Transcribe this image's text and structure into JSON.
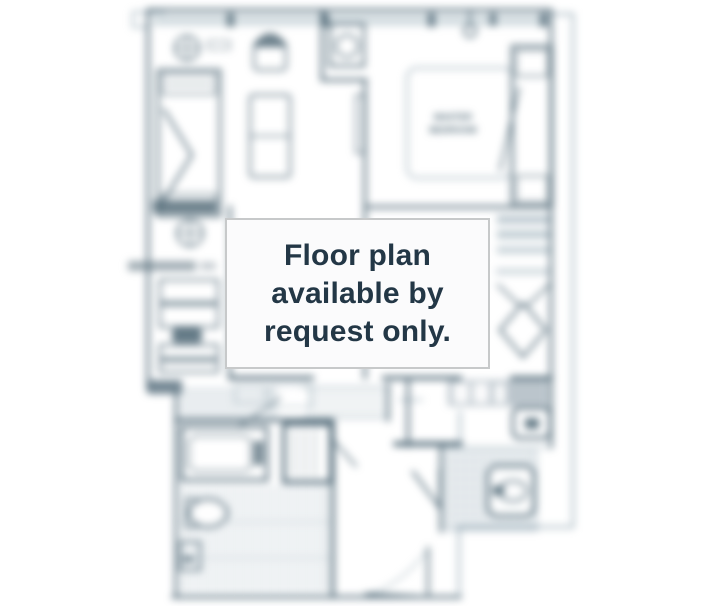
{
  "overlay": {
    "message_lines": [
      "Floor plan",
      "available by",
      "request only."
    ]
  },
  "floor_plan": {
    "room_labels": {
      "master_line1": "MASTER",
      "master_line2": "BEDROOM"
    }
  },
  "colors": {
    "wall": "#46606f",
    "wall_light": "#90a5b1",
    "band_fill": "#bfccd3",
    "overlay_text": "#233746",
    "overlay_border": "#c7c9ca",
    "overlay_bg": "#fbfbfc"
  }
}
